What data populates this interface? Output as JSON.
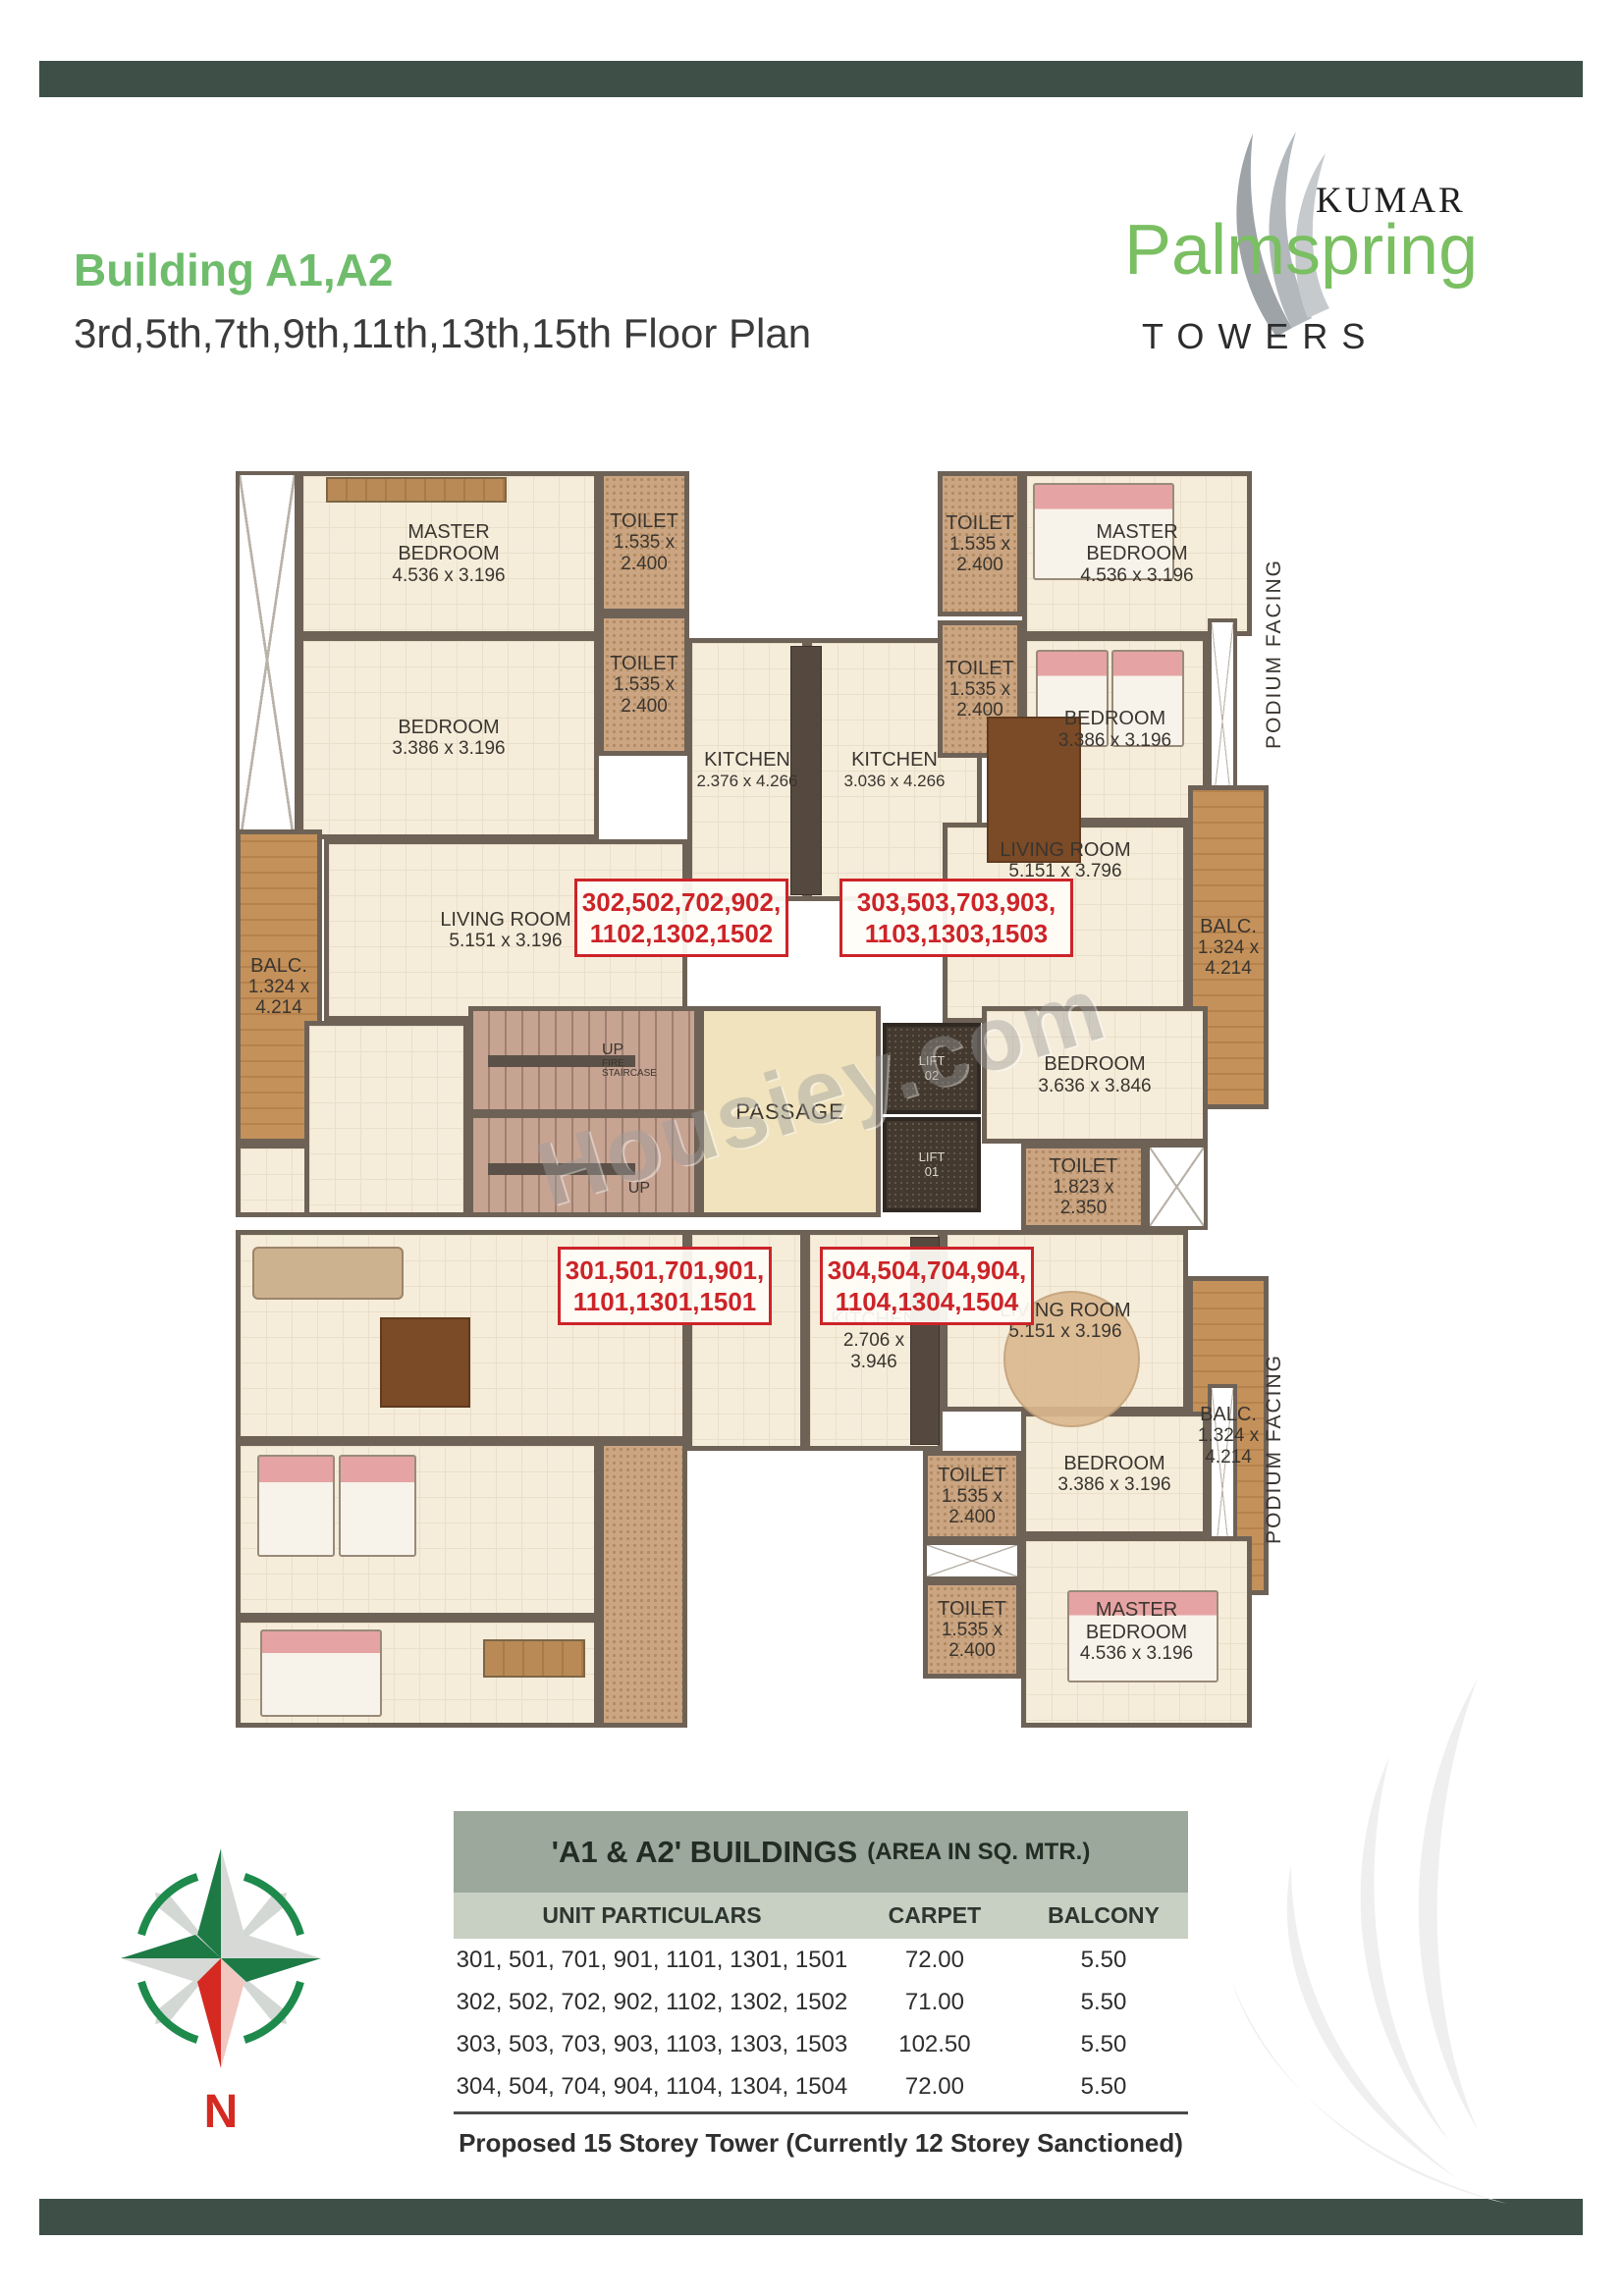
{
  "page": {
    "title": "Building A1,A2",
    "subtitle": "3rd,5th,7th,9th,11th,13th,15th Floor Plan"
  },
  "logo": {
    "kumar": "KUMAR",
    "name": "Palmspring",
    "towers": "TOWERS"
  },
  "colors": {
    "accent_green": "#6fbd6c",
    "band_green": "#3d4f47",
    "unit_red": "#cc2428",
    "table_header": "#9ba89b",
    "table_subheader": "#c8cfc3"
  },
  "plan": {
    "watermark": "Housiey.com",
    "podium": "PODIUM FACING",
    "rooms": {
      "master": {
        "name": "MASTER BEDROOM",
        "dims": "4.536 x 3.196"
      },
      "bedroom_std": {
        "name": "BEDROOM",
        "dims": "3.386 x 3.196"
      },
      "bedroom_mid": {
        "name": "BEDROOM",
        "dims": "3.636 x 3.846"
      },
      "toilet_small": {
        "name": "TOILET",
        "dims": "1.535 x 2.400"
      },
      "toilet_mid": {
        "name": "TOILET",
        "dims": "1.823 x 2.350"
      },
      "kitchen_left": {
        "name": "KITCHEN",
        "dims": "2.376 x 4.266"
      },
      "kitchen_right": {
        "name": "KITCHEN",
        "dims": "3.036 x 4.266"
      },
      "kitchen_bottom": {
        "name": "KITCHEN",
        "dims": "2.706 x 3.946"
      },
      "living_std": {
        "name": "LIVING ROOM",
        "dims": "5.151 x 3.196"
      },
      "living_large": {
        "name": "LIVING ROOM",
        "dims": "5.151 x 3.796"
      },
      "balc": {
        "name": "BALC.",
        "dims": "1.324 x 4.214"
      }
    },
    "core": {
      "up": "UP",
      "fire": "FIRE",
      "staircase": "STAIRCASE",
      "passage": "PASSAGE",
      "lift": "LIFT",
      "lift_02": "02",
      "lift_01": "01"
    },
    "unit_boxes": {
      "u302": {
        "line1": "302,502,702,902,",
        "line2": "1102,1302,1502"
      },
      "u303": {
        "line1": "303,503,703,903,",
        "line2": "1103,1303,1503"
      },
      "u301": {
        "line1": "301,501,701,901,",
        "line2": "1101,1301,1501"
      },
      "u304": {
        "line1": "304,504,704,904,",
        "line2": "1104,1304,1504"
      }
    }
  },
  "compass": {
    "north": "N"
  },
  "table": {
    "title_main": "'A1 & A2'  BUILDINGS",
    "title_note": "(AREA IN SQ. MTR.)",
    "columns": [
      "UNIT PARTICULARS",
      "CARPET",
      "BALCONY"
    ],
    "rows": [
      {
        "units": "301, 501, 701, 901, 1101, 1301, 1501",
        "carpet": "72.00",
        "balcony": "5.50"
      },
      {
        "units": "302, 502, 702, 902, 1102, 1302, 1502",
        "carpet": "71.00",
        "balcony": "5.50"
      },
      {
        "units": "303, 503, 703, 903, 1103, 1303, 1503",
        "carpet": "102.50",
        "balcony": "5.50"
      },
      {
        "units": "304, 504, 704, 904, 1104, 1304, 1504",
        "carpet": "72.00",
        "balcony": "5.50"
      }
    ],
    "note": "Proposed 15 Storey Tower (Currently 12 Storey Sanctioned)"
  }
}
